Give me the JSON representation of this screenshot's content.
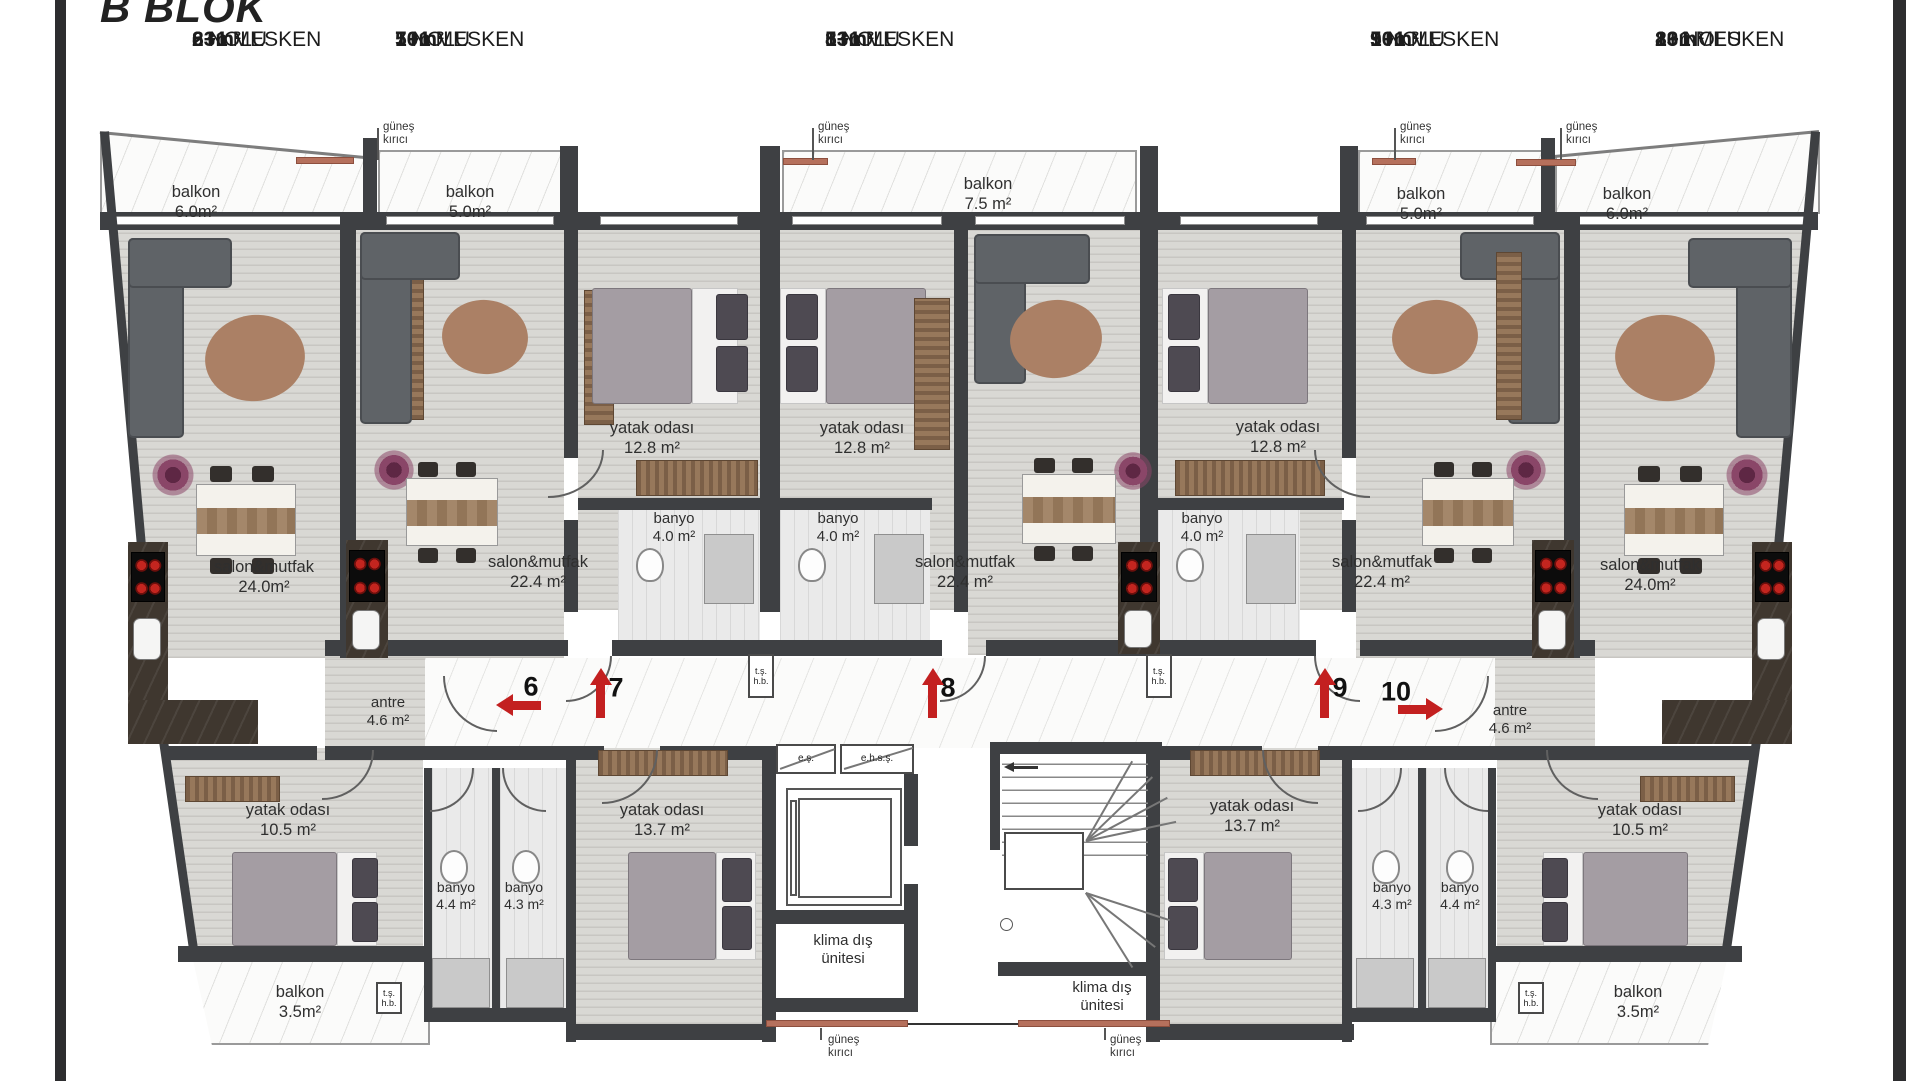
{
  "title": "B BLOK",
  "units": [
    {
      "num": "6",
      "nolu": "NOLU",
      "type": "2+1",
      "mesken": "MESKEN",
      "area": "83m²"
    },
    {
      "num": "7",
      "nolu": "NOLU",
      "type": "1+1",
      "mesken": "MESKEN",
      "area": "50m²"
    },
    {
      "num": "8",
      "nolu": "NOLU",
      "type": "1+1",
      "mesken": "MESKEN",
      "area": "53m²"
    },
    {
      "num": "9",
      "nolu": "NOLU",
      "type": "1+1",
      "mesken": "MESKEN",
      "area": "50m²"
    },
    {
      "num": "10",
      "nolu": "NOLU",
      "type": "2+1",
      "mesken": "MESKEN",
      "area": "83m²"
    }
  ],
  "rooms": {
    "balkon6": {
      "name": "balkon",
      "area": "6.0m²"
    },
    "balkon7": {
      "name": "balkon",
      "area": "5.0m²"
    },
    "balkon8": {
      "name": "balkon",
      "area": "7.5 m²"
    },
    "balkon9": {
      "name": "balkon",
      "area": "5.0m²"
    },
    "balkon10": {
      "name": "balkon",
      "area": "6.0m²"
    },
    "yatak_a": {
      "name": "yatak odası",
      "area": "12.8 m²"
    },
    "yatak_b": {
      "name": "yatak odası",
      "area": "12.8 m²"
    },
    "yatak_c": {
      "name": "yatak odası",
      "area": "12.8 m²"
    },
    "banyo_a": {
      "name": "banyo",
      "area": "4.0 m²"
    },
    "banyo_b": {
      "name": "banyo",
      "area": "4.0 m²"
    },
    "banyo_c": {
      "name": "banyo",
      "area": "4.0 m²"
    },
    "salon6": {
      "name": "salon&mutfak",
      "area": "24.0m²"
    },
    "salon7": {
      "name": "salon&mutfak",
      "area": "22.4 m²"
    },
    "salon8": {
      "name": "salon&mutfak",
      "area": "22.4 m²"
    },
    "salon9": {
      "name": "salon&mutfak",
      "area": "22.4 m²"
    },
    "salon10": {
      "name": "salon&mutfak",
      "area": "24.0m²"
    },
    "antre_l": {
      "name": "antre",
      "area": "4.6 m²"
    },
    "antre_r": {
      "name": "antre",
      "area": "4.6 m²"
    },
    "yatak10_l": {
      "name": "yatak odası",
      "area": "10.5 m²"
    },
    "yatak13_l": {
      "name": "yatak odası",
      "area": "13.7 m²"
    },
    "yatak13_r": {
      "name": "yatak odası",
      "area": "13.7 m²"
    },
    "yatak10_r": {
      "name": "yatak odası",
      "area": "10.5 m²"
    },
    "banyo44_l": {
      "name": "banyo",
      "area": "4.4 m²"
    },
    "banyo43_l": {
      "name": "banyo",
      "area": "4.3 m²"
    },
    "banyo43_r": {
      "name": "banyo",
      "area": "4.3 m²"
    },
    "banyo44_r": {
      "name": "banyo",
      "area": "4.4 m²"
    },
    "balkon35_l": {
      "name": "balkon",
      "area": "3.5m²"
    },
    "balkon35_r": {
      "name": "balkon",
      "area": "3.5m²"
    },
    "klima_l": {
      "line1": "klima dış",
      "line2": "ünitesi"
    },
    "klima_r": {
      "line1": "klima dış",
      "line2": "ünitesi"
    }
  },
  "annotations": {
    "gunes_line1": "güneş",
    "gunes_line2": "kırıcı",
    "es": "e.ş.",
    "ehss": "e.h.s.ş.",
    "ts": "t.ş.",
    "hb": "h.b."
  },
  "markers": [
    {
      "label": "6"
    },
    {
      "label": "7"
    },
    {
      "label": "8"
    },
    {
      "label": "9"
    },
    {
      "label": "10"
    }
  ],
  "colors": {
    "wall": "#3e4043",
    "arrow_red": "#c32020",
    "sun_breaker": "#b5705c"
  }
}
